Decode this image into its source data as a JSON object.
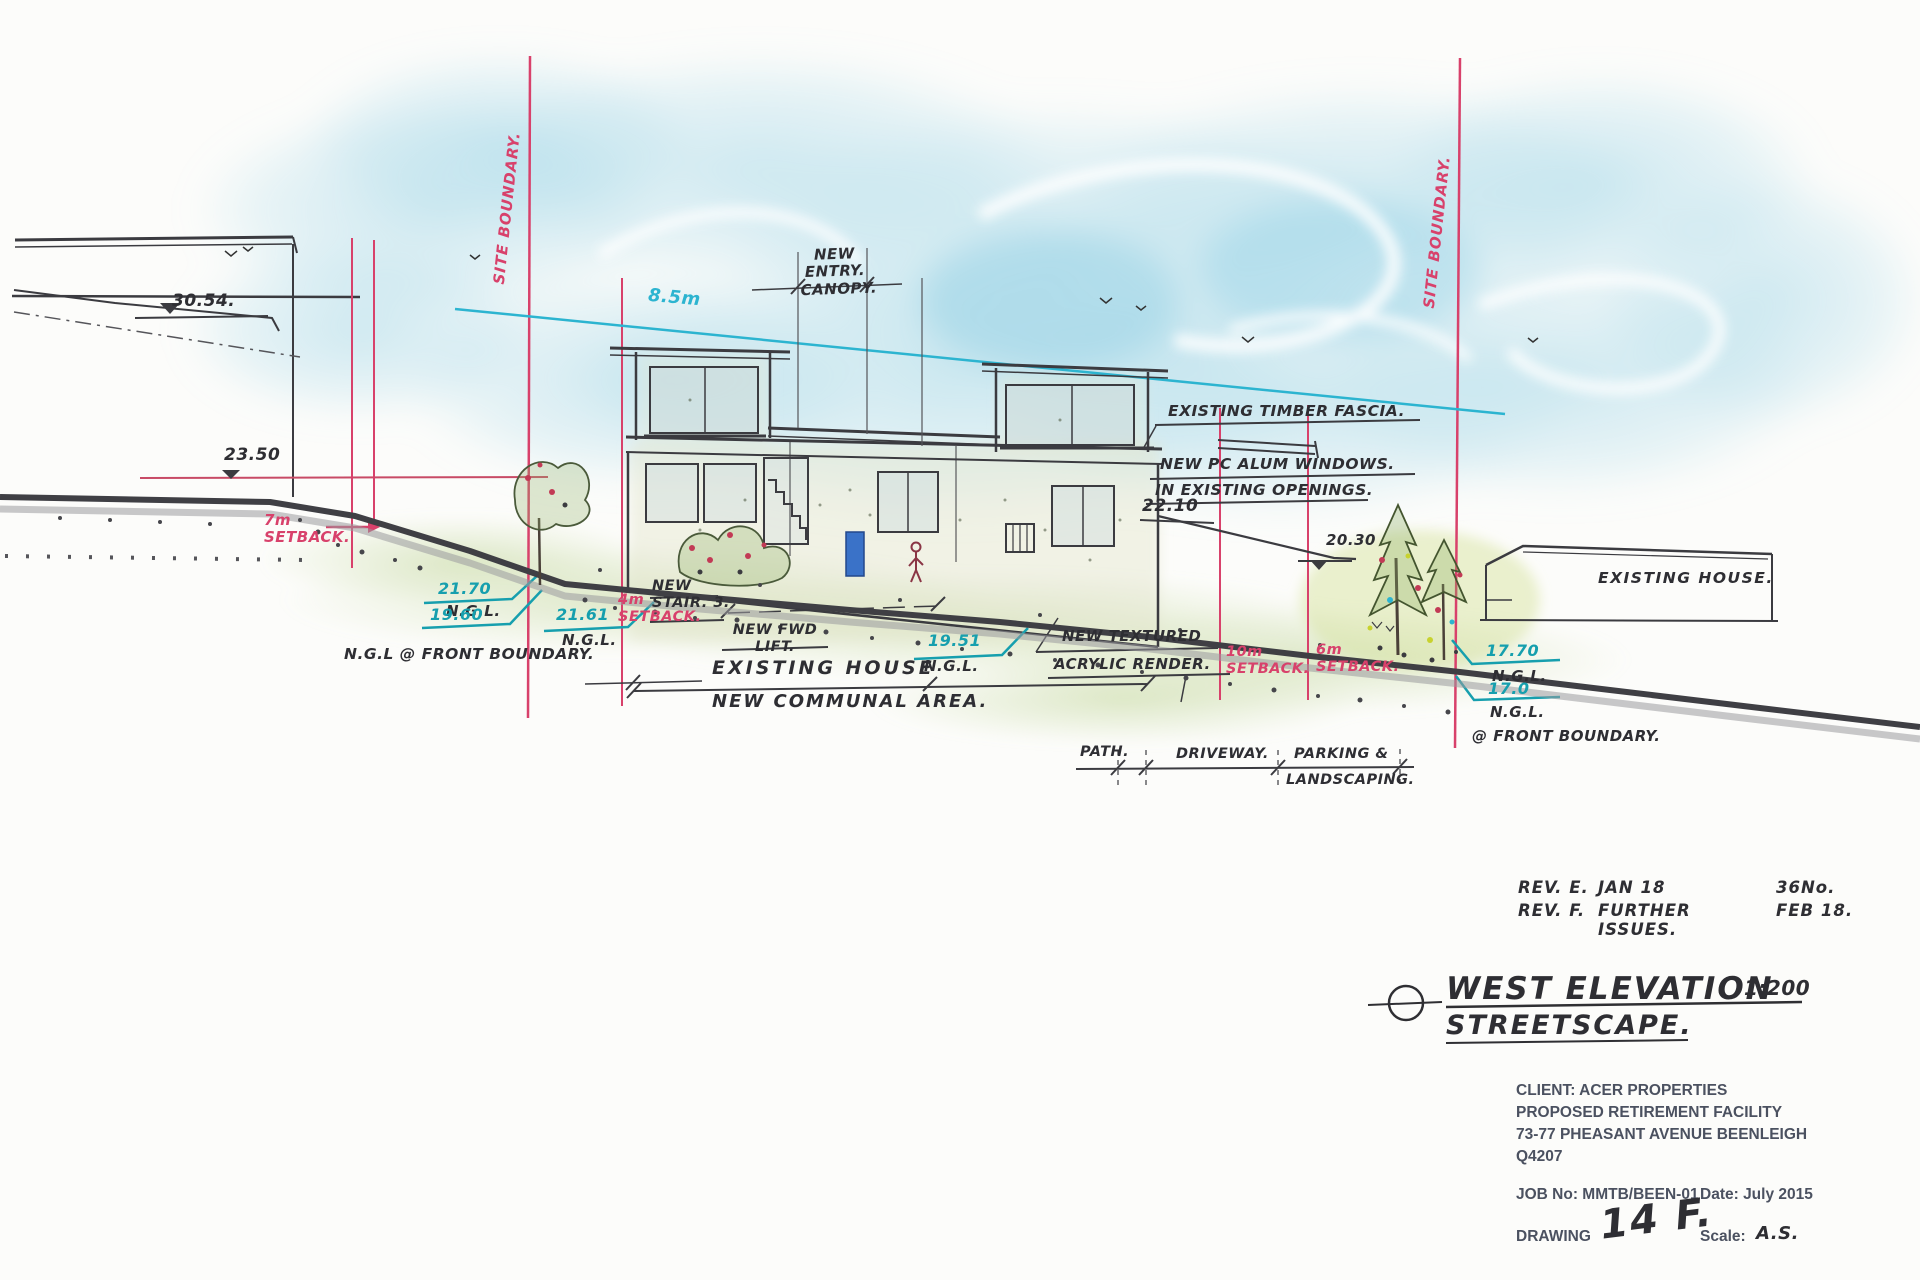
{
  "labels": {
    "level_3054": "30.54.",
    "level_2350": "23.50",
    "level_2210": "22.10",
    "level_2030": "20.30",
    "site_boundary_left": "SITE BOUNDARY.",
    "site_boundary_right": "SITE BOUNDARY.",
    "setback_7m": "7m",
    "setback_4m": "4m",
    "setback_10m": "10m",
    "setback_6m": "6m",
    "setback_word": "SETBACK.",
    "height_limit": "8.5m",
    "canopy1": "NEW",
    "canopy2": "ENTRY.",
    "canopy3": "CANOPY.",
    "fascia": "EXISTING TIMBER FASCIA.",
    "windows1": "NEW PC ALUM WINDOWS.",
    "windows2": "IN EXISTING OPENINGS.",
    "ngl": "N.G.L.",
    "ngl_2170": "21.70",
    "ngl_1960": "19.60",
    "ngl_2161": "21.61",
    "ngl_1951": "19.51",
    "ngl_1770": "17.70",
    "ngl_170": "17.0",
    "ngl_front_boundary": "N.G.L @ FRONT BOUNDARY.",
    "at_front_boundary": "@ FRONT BOUNDARY.",
    "stair1": "NEW",
    "stair2": "STAIR. 3.",
    "lift1": "NEW FWD",
    "lift2": "LIFT.",
    "existing_house": "EXISTING HOUSE",
    "communal": "NEW COMMUNAL AREA.",
    "render1": "NEW TEXTURED",
    "render2": "ACRYLIC RENDER.",
    "existing_house_right": "EXISTING HOUSE.",
    "path": "PATH.",
    "driveway": "DRIVEWAY.",
    "parking1": "PARKING &",
    "parking2": "LANDSCAPING."
  },
  "revisions": {
    "row1": {
      "rev": "REV. E.",
      "desc": "JAN 18",
      "extra": "36No."
    },
    "row2": {
      "rev": "REV. F.",
      "desc": "FURTHER ISSUES.",
      "extra": "FEB 18."
    }
  },
  "title": {
    "name": "WEST ELEVATION",
    "subtitle": "STREETSCAPE.",
    "scale": "1:200"
  },
  "title_block": {
    "client": "CLIENT: ACER PROPERTIES",
    "project": "PROPOSED RETIREMENT FACILITY",
    "address": "73-77 PHEASANT AVENUE BEENLEIGH",
    "postcode": "Q4207",
    "job_no": "JOB No: MMTB/BEEN-01",
    "date": "Date: July 2015",
    "drawing_label": "DRAWING",
    "drawing_no": "14 F.",
    "scale_label": "Scale:",
    "scale_value": "A.S."
  },
  "colors": {
    "boundary_red": "#d8416b",
    "annotation_teal": "#169fae",
    "height_line_cyan": "#2cb4d0",
    "pencil": "#3b3b40",
    "wash_cyan": "#a8d9e9",
    "grass_green": "#c4d89e",
    "door_blue": "#3a72c8"
  }
}
